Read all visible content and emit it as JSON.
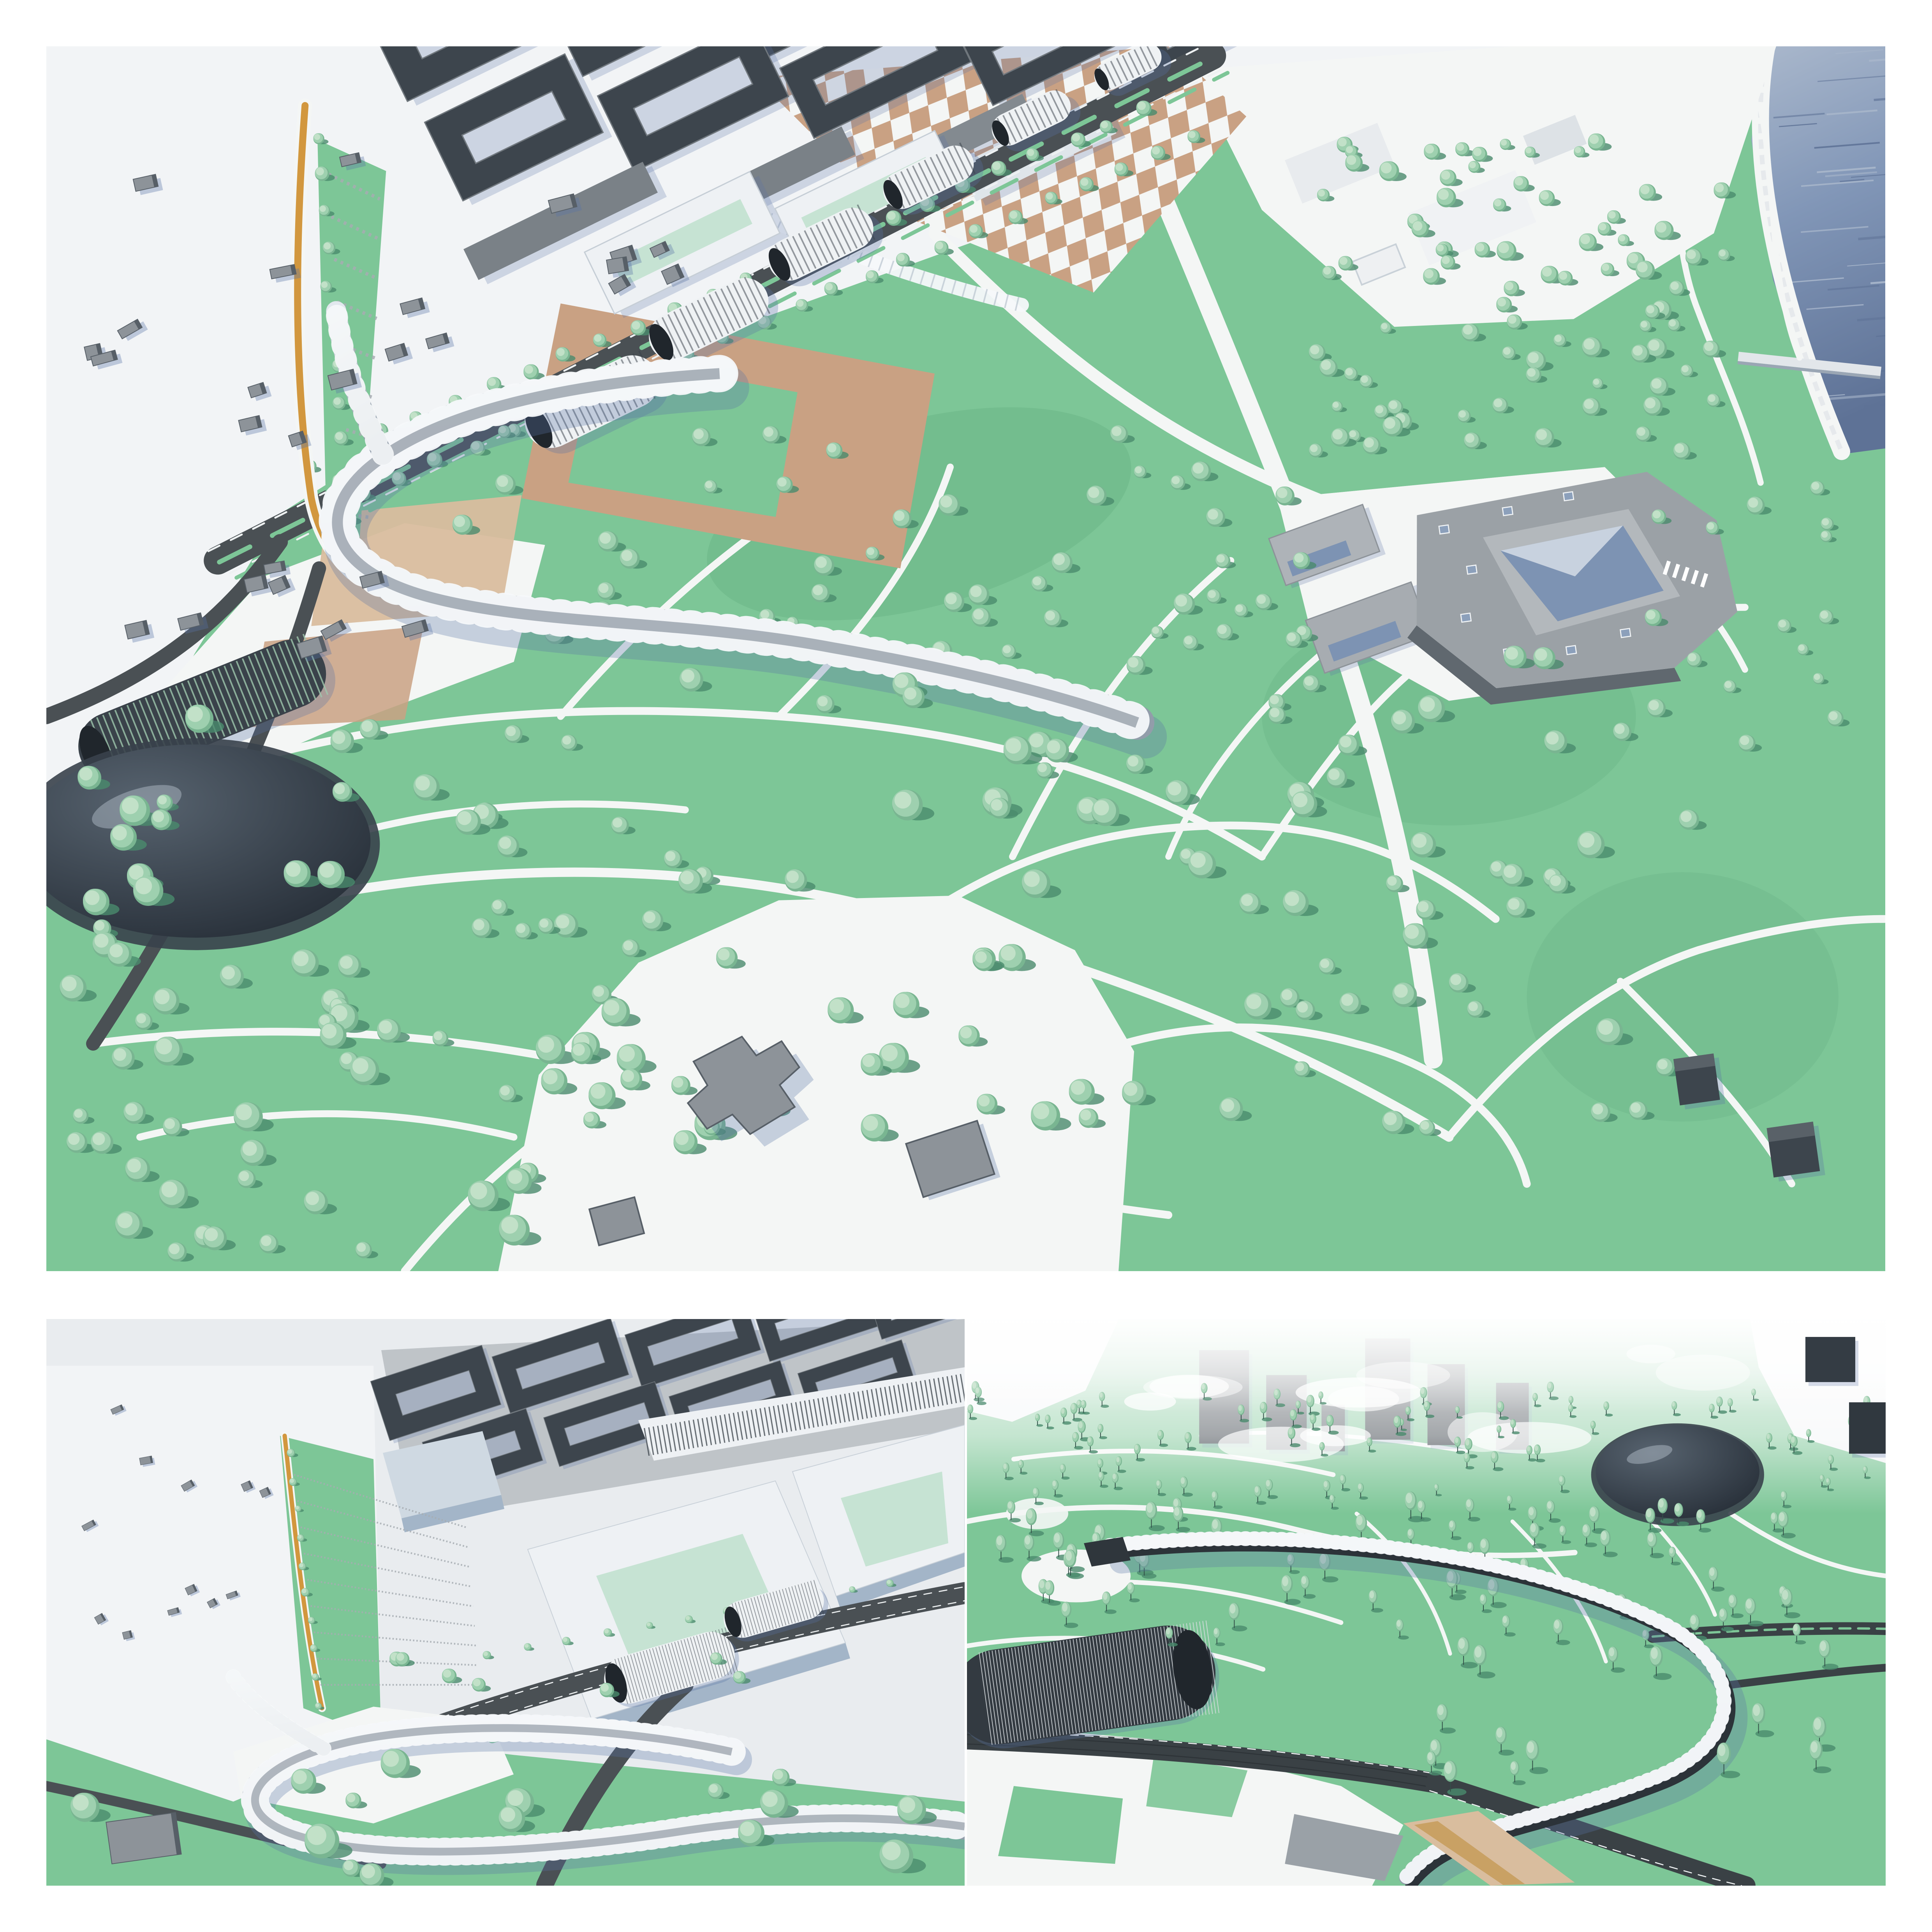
{
  "figure": {
    "title": "Park masterplan 3D renderings collage",
    "panels": [
      {
        "id": "top",
        "name": "aerial-overview",
        "description": "Bird's-eye rendering of a riverside park masterplan: dark city perimeter blocks and white courtyard buildings along a tree-lined boulevard, a row of ribbed vaulted halls beside a tan-and-white checkerboard plaza, a looped glass canopy bridge, organic white path network through lawns with round trees, a grey museum courtyard complex, a dark glossy dome pavilion, sports courts, and a waterfront with pier at the top right"
      },
      {
        "id": "bottom-left",
        "name": "bridge-closeup-west",
        "description": "Close-up of the looped glass canopy bridge at a boulevard junction, with ochre waterfront promenade, hatched lawn wedges, white perimeter blocks with green triangular courtyards and dark city blocks behind"
      },
      {
        "id": "bottom-right",
        "name": "bridge-closeup-east",
        "description": "Close-up of the curved glass canopy bridge sweeping over roads beside a dark ribbed vault hall and a dark ellipsoid dome, among dense park trees fading into white haze with tower silhouettes"
      }
    ]
  },
  "scene": {
    "palette": {
      "lawn": "#7dc697",
      "lawn_dark": "#69b386",
      "path": "#f4f6f5",
      "terrain": "#e9ecef",
      "terrain_bright": "#f2f4f6",
      "tree_light": "#c5e2cb",
      "tree_mid": "#9ed0af",
      "tree_dark": "#79b591",
      "tree_shadow": "#4a8b6d",
      "trunk": "#324f48",
      "road": "#4a5054",
      "road_dark": "#3a4145",
      "lane": "#eef1f2",
      "block_dark": "#3d454d",
      "block_roof": "#70777d",
      "grey_bldg": "#8d9399",
      "grey_bldg_side": "#575f67",
      "white_roof": "#eef1f4",
      "white_wall": "#d9e0e7",
      "white_side": "#a3b5c8",
      "courtyard": "#c6e3d3",
      "tan": "#c9a183",
      "tan_light": "#d9bd9e",
      "ochre": "#d2973e",
      "water_main": "#8196b7",
      "water_light": "#aab8cc",
      "water_deep": "#5e7296",
      "dome_hi": "#57636f",
      "dome_lo": "#1e252e",
      "glass_hi": "#e2e8ee",
      "glass_lo": "#929daa",
      "rib": "#f6f8fa",
      "vault_body": "#eff2f4",
      "museum": "#9ba1a6",
      "museum_side": "#60686f",
      "museum_glass": "#7d93b3",
      "shadow_blue": "#5a74a6",
      "haze": "#f7f9fb"
    },
    "generated": [
      {
        "panel": "top",
        "layer": "t-city-blocks",
        "kind": "blocks",
        "items": [
          [
            268,
            -18,
            112,
            64,
            -26,
            "ring"
          ],
          [
            385,
            -34,
            120,
            60,
            -26,
            "ring"
          ],
          [
            505,
            -46,
            128,
            58,
            -26,
            "ring"
          ],
          [
            625,
            -56,
            126,
            54,
            -26,
            "ring"
          ],
          [
            738,
            -62,
            112,
            48,
            -26,
            "ring"
          ],
          [
            838,
            -64,
            96,
            42,
            -26,
            "ring"
          ],
          [
            300,
            52,
            100,
            56,
            -26,
            "ring"
          ],
          [
            415,
            32,
            110,
            54,
            -26,
            "ring"
          ],
          [
            532,
            12,
            112,
            50,
            -26,
            "ring"
          ],
          [
            645,
            -6,
            106,
            46,
            -26,
            "ring"
          ],
          [
            748,
            -20,
            96,
            40,
            -26,
            "ring"
          ],
          [
            330,
            112,
            128,
            22,
            -26,
            "slab",
            "#7a8187"
          ],
          [
            458,
            88,
            126,
            20,
            -26,
            "slab",
            "#7a8187"
          ],
          [
            578,
            64,
            116,
            18,
            -26,
            "slab",
            "#838a90"
          ]
        ]
      },
      {
        "panel": "top",
        "layer": "t-white-blocks",
        "kind": "blocks",
        "items": [
          [
            408,
            126,
            118,
            44,
            -26,
            "white-ring"
          ],
          [
            528,
            98,
            114,
            42,
            -26,
            "white-ring"
          ],
          [
            636,
            66,
            100,
            26,
            -26,
            "slab",
            "#dfe5ea"
          ]
        ]
      },
      {
        "panel": "top",
        "layer": "t-houses",
        "kind": "houses",
        "region": [
          15,
          60,
          250,
          330
        ],
        "count": 22,
        "seed": 3
      },
      {
        "panel": "top",
        "layer": "t-houses2",
        "kind": "houses",
        "region": [
          255,
          92,
          150,
          115
        ],
        "count": 6,
        "seed": 4
      },
      {
        "panel": "top",
        "layer": "t-hatch-ramp",
        "kind": "hatch",
        "lineA": [
          181,
          82,
          198,
          328
        ],
        "lineB": [
          214,
          98,
          208,
          328
        ],
        "count": 10
      },
      {
        "panel": "top",
        "layer": "t-vaults",
        "kind": "vault",
        "items": [
          [
            350,
            228,
            92,
            34,
            -26,
            "light"
          ],
          [
            425,
            175,
            82,
            30,
            -26,
            "light"
          ],
          [
            497,
            127,
            72,
            27,
            -26,
            "light"
          ],
          [
            566,
            84,
            62,
            24,
            -26,
            "light"
          ],
          [
            632,
            46,
            54,
            21,
            -26,
            "light"
          ],
          [
            694,
            13,
            46,
            18,
            -26,
            "light"
          ],
          [
            100,
            426,
            168,
            44,
            -22,
            "dark"
          ]
        ]
      },
      {
        "panel": "top",
        "layer": "t-water-streaks",
        "kind": "streaks",
        "region": [
          1098,
          4,
          78,
          248
        ],
        "count": 30,
        "seed": 9
      },
      {
        "panel": "top",
        "layer": "t-woods-e",
        "kind": "scatter",
        "style": "round",
        "region": [
          810,
          60,
          270,
          205
        ],
        "count": 85,
        "r": [
          3.5,
          6.5
        ],
        "seed": 31
      },
      {
        "panel": "top",
        "layer": "t-shore-trees",
        "kind": "scatter",
        "style": "round",
        "region": [
          1030,
          260,
          130,
          190
        ],
        "count": 15,
        "r": [
          3.5,
          6
        ],
        "seed": 32
      },
      {
        "panel": "top",
        "layer": "t-mid-field",
        "kind": "scatter",
        "style": "round",
        "region": [
          260,
          240,
          430,
          150
        ],
        "count": 30,
        "r": [
          4,
          7
        ],
        "seed": 33
      },
      {
        "panel": "top",
        "layer": "t-museum-trees",
        "kind": "scatter",
        "style": "round",
        "region": [
          700,
          255,
          110,
          130
        ],
        "count": 16,
        "r": [
          4,
          7
        ],
        "seed": 34
      },
      {
        "panel": "top",
        "layer": "t-sw",
        "kind": "scatter",
        "style": "round",
        "region": [
          15,
          430,
          300,
          345
        ],
        "count": 65,
        "r": [
          5,
          10
        ],
        "seed": 35
      },
      {
        "panel": "top",
        "layer": "t-s",
        "kind": "scatter",
        "style": "round",
        "region": [
          315,
          405,
          370,
          300
        ],
        "count": 55,
        "r": [
          5,
          10
        ],
        "seed": 36
      },
      {
        "panel": "top",
        "layer": "t-se",
        "kind": "scatter",
        "style": "round",
        "region": [
          695,
          385,
          370,
          310
        ],
        "count": 50,
        "r": [
          5,
          9
        ],
        "seed": 37
      },
      {
        "panel": "top",
        "layer": "t-row-blvd1",
        "kind": "row",
        "line": [
          168,
          268,
          706,
          40
        ],
        "count": 24,
        "r": [
          4,
          5
        ],
        "seed": 38
      },
      {
        "panel": "top",
        "layer": "t-row-blvd2",
        "kind": "row",
        "line": [
          206,
          286,
          736,
          58
        ],
        "count": 24,
        "r": [
          4,
          5
        ],
        "seed": 39
      },
      {
        "panel": "top",
        "layer": "t-row-ramp",
        "kind": "row",
        "line": [
          174,
          58,
          194,
          326
        ],
        "count": 12,
        "r": [
          3.5,
          5
        ],
        "seed": 40
      },
      {
        "panel": "bl",
        "layer": "bl-city-blocks",
        "kind": "blocks",
        "items": [
          [
            500,
            95,
            150,
            80,
            -18,
            "ring"
          ],
          [
            660,
            60,
            160,
            76,
            -18,
            "ring"
          ],
          [
            830,
            30,
            160,
            72,
            -18,
            "ring"
          ],
          [
            990,
            0,
            150,
            66,
            -18,
            "ring"
          ],
          [
            1130,
            -24,
            140,
            60,
            -18,
            "ring"
          ],
          [
            560,
            170,
            140,
            70,
            -18,
            "ring"
          ],
          [
            720,
            135,
            150,
            66,
            -18,
            "ring"
          ],
          [
            880,
            105,
            150,
            60,
            -18,
            "ring"
          ],
          [
            1040,
            75,
            140,
            56,
            -18,
            "ring"
          ]
        ]
      },
      {
        "panel": "bl",
        "layer": "bl-houses",
        "kind": "houses",
        "region": [
          20,
          110,
          280,
          330
        ],
        "count": 12,
        "seed": 5
      },
      {
        "panel": "bl",
        "layer": "bl-hatch",
        "kind": "hatch",
        "lineA": [
          318,
          200,
          352,
          470
        ],
        "lineB": [
          540,
          268,
          556,
          470
        ],
        "count": 9
      },
      {
        "panel": "bl",
        "layer": "bl-vaults",
        "kind": "vault",
        "items": [
          [
            800,
            448,
            172,
            62,
            -16,
            "light"
          ],
          [
            934,
            374,
            132,
            48,
            -16,
            "light"
          ]
        ]
      },
      {
        "panel": "bl",
        "layer": "bl-row-ochre",
        "kind": "row",
        "line": [
          312,
          172,
          352,
          496
        ],
        "count": 10,
        "r": [
          4,
          6
        ],
        "seed": 41
      },
      {
        "panel": "bl",
        "layer": "bl-row-blvd",
        "kind": "row",
        "line": [
          565,
          432,
          1085,
          338
        ],
        "count": 11,
        "r": [
          4,
          5.5
        ],
        "seed": 42
      },
      {
        "panel": "bl",
        "layer": "bl-mid-trees",
        "kind": "scatter",
        "style": "round",
        "region": [
          430,
          430,
          460,
          110
        ],
        "count": 9,
        "r": [
          6,
          10
        ],
        "seed": 43
      },
      {
        "panel": "bl",
        "layer": "bl-fg-trees",
        "kind": "scatter",
        "style": "round",
        "region": [
          40,
          565,
          1080,
          150
        ],
        "count": 15,
        "r": [
          10,
          24
        ],
        "seed": 44
      },
      {
        "panel": "br",
        "layer": "br-towers",
        "kind": "blocks",
        "items": [
          [
            330,
            100,
            64,
            120,
            0,
            "slab",
            "#303840"
          ],
          [
            410,
            120,
            52,
            96,
            0,
            "slab",
            "#343c44"
          ],
          [
            540,
            90,
            58,
            130,
            0,
            "slab",
            "#2c343c"
          ],
          [
            615,
            110,
            48,
            104,
            0,
            "slab",
            "#333b43"
          ],
          [
            700,
            125,
            42,
            86,
            0,
            "slab",
            "#3a424a"
          ],
          [
            470,
            140,
            30,
            60,
            0,
            "slab",
            "#4a525a"
          ]
        ]
      },
      {
        "panel": "br",
        "layer": "br-right-blocks",
        "kind": "blocks",
        "items": [
          [
            1108,
            52,
            64,
            58,
            0,
            "slab",
            "#343c44"
          ],
          [
            1158,
            140,
            52,
            66,
            0,
            "slab",
            "#30383f"
          ]
        ]
      },
      {
        "panel": "br",
        "layer": "br-clouds",
        "kind": "clouds",
        "region": [
          120,
          40,
          900,
          140
        ],
        "count": 14,
        "seed": 21
      },
      {
        "panel": "br",
        "layer": "br-vault",
        "kind": "vault",
        "items": [
          [
            150,
            470,
            340,
            122,
            -8,
            "darkbig"
          ]
        ]
      },
      {
        "panel": "br",
        "layer": "br-back",
        "kind": "scatter",
        "style": "tall",
        "region": [
          0,
          100,
          1179,
          145
        ],
        "count": 95,
        "r": [
          4.5,
          8
        ],
        "seed": 51
      },
      {
        "panel": "br",
        "layer": "br-mid",
        "kind": "scatter",
        "style": "tall",
        "region": [
          30,
          255,
          1120,
          165
        ],
        "count": 70,
        "r": [
          7,
          12
        ],
        "seed": 52
      },
      {
        "panel": "br",
        "layer": "br-fg",
        "kind": "scatter",
        "style": "tall",
        "region": [
          560,
          430,
          560,
          185
        ],
        "count": 16,
        "r": [
          9,
          14
        ],
        "seed": 53
      }
    ]
  }
}
